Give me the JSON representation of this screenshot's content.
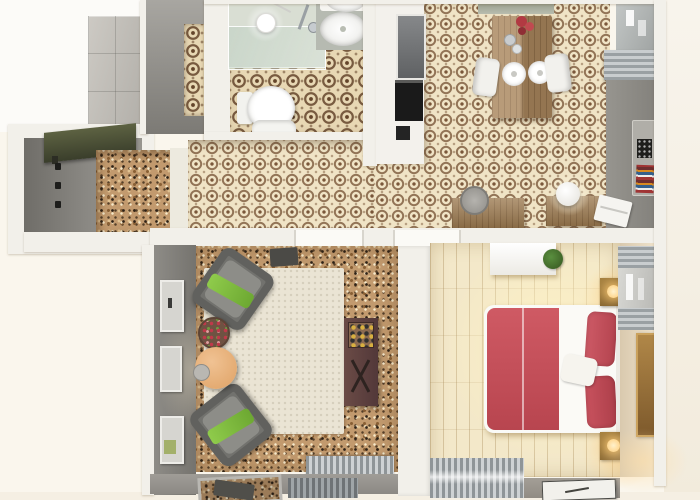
{
  "scene": {
    "type": "3d-floor-plan-render",
    "label": "Top-down 3D render of a one-bedroom apartment",
    "background_color": "#faf6ed"
  },
  "palette": {
    "outside": "#faf6ed",
    "wall_white": "#f2f0ea",
    "wall_gray": "#8e8c87",
    "tile_base": "#f0e4c6",
    "tile_motif": "#7a573a",
    "cork_base": "#c29a6e",
    "wood_floor": "#f3e8c9",
    "rug_cream": "#eae4d4",
    "armchair_gray": "#72726e",
    "throw_green": "#84c141",
    "coffee_table_peach": "#e9b37f",
    "sideboard_brown": "#5f4440",
    "bed_red": "#c6505c",
    "nightstand_wood": "#8a6a3e",
    "lamp_glow": "#ffd9a0",
    "dining_wood": "#a8855c",
    "radiator_gray": "#9aa0a3",
    "bench_olive": "#4c5036",
    "stone_column": "#c0bdb7",
    "shower_glass": "#c1d1c4"
  },
  "rooms": {
    "entry_hall": {
      "label": "Entry hall — coat hooks, olive bench, cork floor"
    },
    "nook": {
      "label": "Closet nook with tiled strip"
    },
    "bathroom": {
      "label": "Bathroom — walk-in shower, pendant light, double vanity, toilet, patterned tile"
    },
    "kitchen": {
      "label": "Kitchen — tall white unit with oven, patterned tile floor"
    },
    "dining": {
      "label": "Dining area — wooden table, two white chairs, plates, flowers"
    },
    "study": {
      "label": "Study nook — two wooden desks, sphere lamp, stool, laptop, book shelf"
    },
    "living_room": {
      "label": "Living room — two gray armchairs with green throws, cream rug, peach coffee table, sideboard, wall frames"
    },
    "bedroom": {
      "label": "Bedroom — red double bed, glowing nightstands, dresser with plant, blinds, radiator, white rug"
    },
    "balcony": {
      "label": "Balcony edge — outdoor chair, radiator grills"
    }
  },
  "furniture": {
    "shower": "walk-in shower with glass panel",
    "pendant": "white pendant light",
    "vanity": "double sink vanity",
    "toilet": "toilet",
    "doormat": "dark doormat",
    "oven": "built-in black oven",
    "table": "wooden dining table",
    "chairs": "white dining chairs",
    "armchair": "gray armchair with green throw",
    "rug": "cream rug",
    "peach_table": "round peach coffee table",
    "flower_table": "round side table with flowers",
    "sideboard": "dark brown sideboard",
    "bed": "double bed with red duvet and pillows",
    "nightstand": "wooden nightstand with lit lamp",
    "dresser": "white dresser",
    "plant": "potted green plant",
    "artwork": "tall bronze wall art",
    "books": "wall shelf with colorful books",
    "laptop": "white laptop",
    "lamp": "white sphere lamp",
    "stool": "gray round stool",
    "bench": "olive entry bench",
    "hooks": "black coat hooks",
    "column": "gray stone tiled column",
    "radiator": "slatted radiator",
    "blinds": "gray venetian blinds"
  }
}
